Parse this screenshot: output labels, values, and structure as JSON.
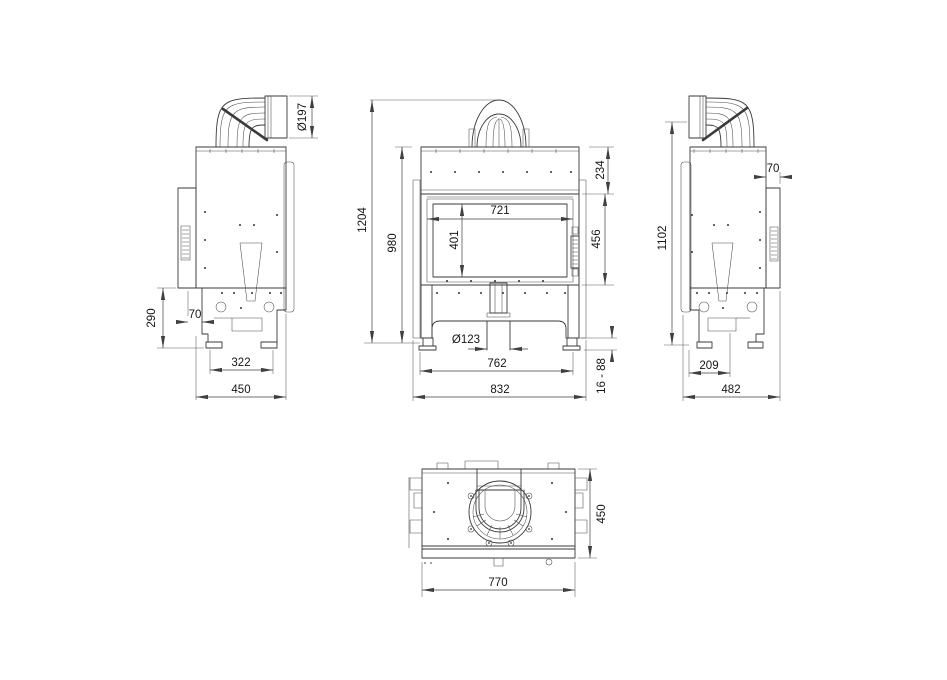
{
  "drawing": {
    "views": {
      "side_left": {
        "dims": {
          "flue_diameter": "Ø197",
          "base_height": "290",
          "panel_offset": "70",
          "feet_spacing": "322",
          "depth": "450"
        }
      },
      "front": {
        "dims": {
          "overall_height": "1204",
          "body_height": "980",
          "top_section_height": "234",
          "glass_width": "721",
          "glass_height": "401",
          "door_height": "456",
          "intake_diameter": "Ø123",
          "inner_width": "762",
          "overall_width": "832",
          "feet_range": "16 - 88"
        }
      },
      "side_right": {
        "dims": {
          "flue_axis_height": "1102",
          "panel_offset": "70",
          "foot_offset": "209",
          "depth": "482"
        }
      },
      "top": {
        "dims": {
          "depth": "450",
          "width": "770"
        }
      }
    }
  }
}
